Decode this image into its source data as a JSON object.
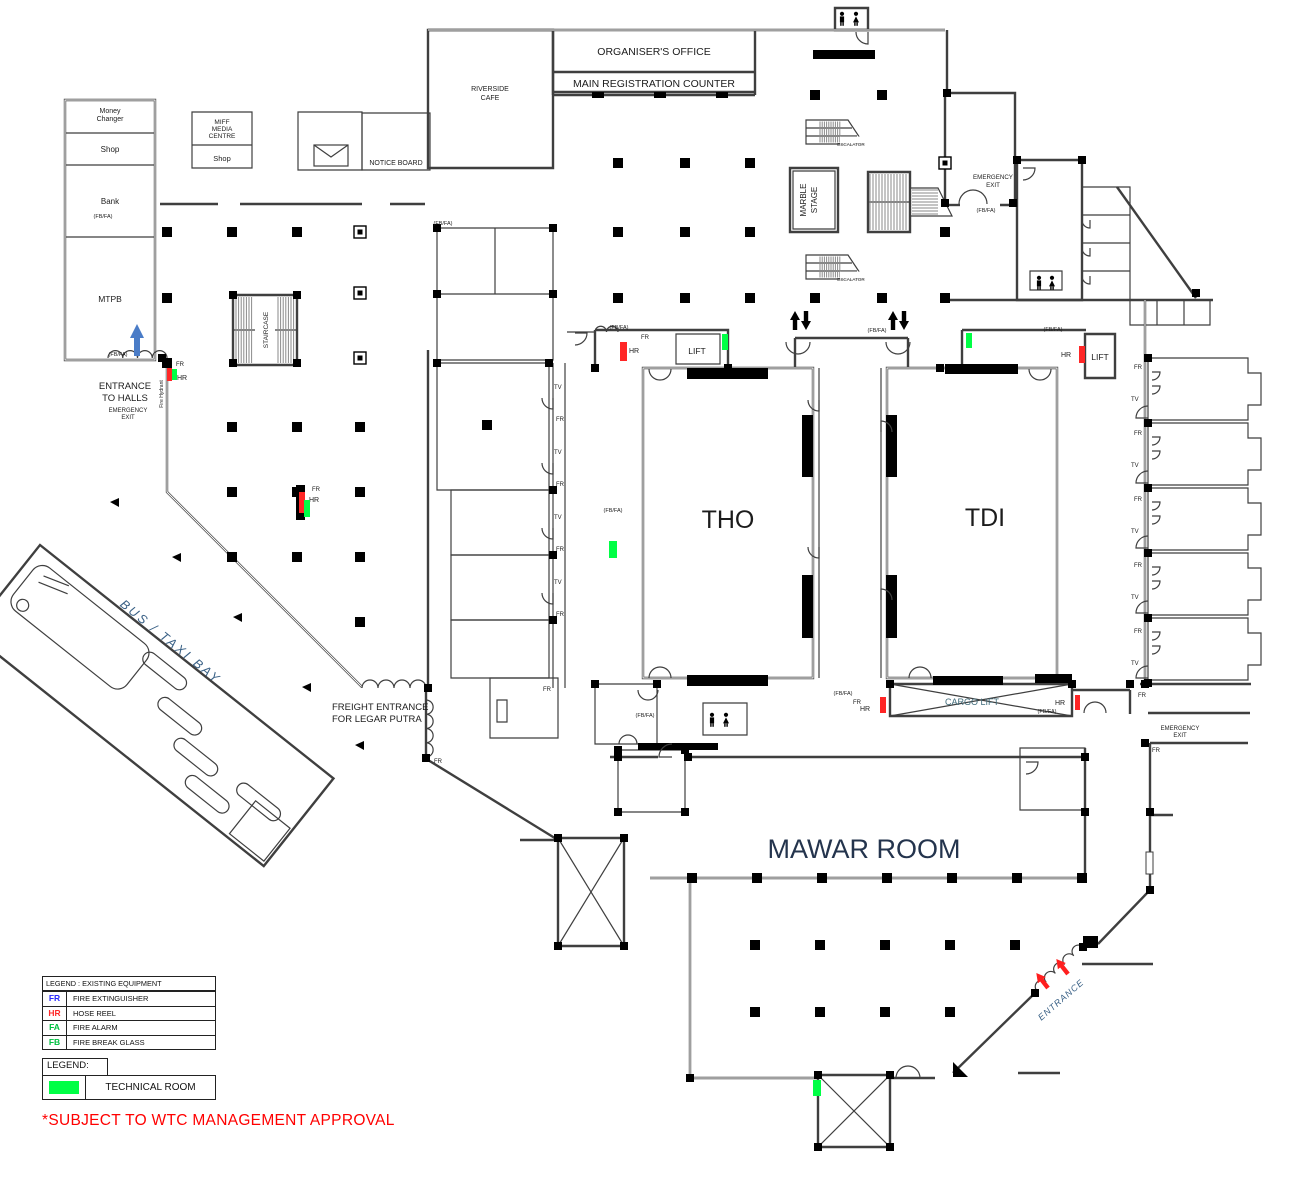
{
  "labels": {
    "shops": {
      "money_changer_l1": "Money",
      "money_changer_l2": "Changer",
      "shop_top": "Shop",
      "bank": "Bank",
      "mtpb": "MTPB",
      "miff_l1": "MIFF",
      "miff_l2": "MEDIA",
      "miff_l3": "CENTRE",
      "shop_mid": "Shop"
    },
    "top": {
      "notice_board": "NOTICE BOARD",
      "riverside_l1": "RIVERSIDE",
      "riverside_l2": "CAFE",
      "organisers_office": "ORGANISER'S OFFICE",
      "main_registration": "MAIN REGISTRATION COUNTER"
    },
    "halls": {
      "tho": "THO",
      "tdi": "TDI",
      "mawar": "MAWAR ROOM",
      "marble_l1": "MARBLE",
      "marble_l2": "STAGE",
      "staircase": "STAIRCASE",
      "escalator": "ESCALATOR",
      "lift": "LIFT",
      "cargo_lift": "CARGO LIFT"
    },
    "circulation": {
      "entrance_to_halls_l1": "ENTRANCE",
      "entrance_to_halls_l2": "TO HALLS",
      "emergency_l1": "EMERGENCY",
      "emergency_l2": "EXIT",
      "entrance": "ENTRANCE",
      "bus_taxi_bay": "BUS / TAXI BAY",
      "freight_l1": "FREIGHT ENTRANCE",
      "freight_l2": "FOR LEGAR PUTRA",
      "fire_hydrant": "Fire Hydrant"
    }
  },
  "legend_equipment": {
    "title": "LEGEND : EXISTING EQUIPMENT",
    "items": [
      {
        "code": "FR",
        "label": "FIRE EXTINGUISHER",
        "color": "#2929ff"
      },
      {
        "code": "HR",
        "label": "HOSE REEL",
        "color": "#ff2a2a"
      },
      {
        "code": "FA",
        "label": "FIRE ALARM",
        "color": "#00c040"
      },
      {
        "code": "FB",
        "label": "FIRE BREAK GLASS",
        "color": "#00c040"
      }
    ]
  },
  "legend_technical": {
    "title": "LEGEND:",
    "label": "TECHNICAL ROOM",
    "swatch": "#00ff45"
  },
  "note": {
    "text": "*SUBJECT TO WTC MANAGEMENT APPROVAL",
    "color": "#ff0000"
  },
  "markers": {
    "fr": {
      "label": "FR",
      "color": "#3a3aff",
      "pos": [
        [
          176,
          366
        ],
        [
          312,
          491
        ],
        [
          641,
          339
        ],
        [
          543,
          691
        ],
        [
          853,
          704
        ],
        [
          1138,
          697
        ],
        [
          1152,
          752
        ],
        [
          434,
          763
        ],
        [
          556,
          421
        ],
        [
          556,
          486
        ],
        [
          556,
          551
        ],
        [
          556,
          616
        ],
        [
          1134,
          369
        ],
        [
          1134,
          435
        ],
        [
          1134,
          501
        ],
        [
          1134,
          567
        ],
        [
          1134,
          633
        ]
      ]
    },
    "tv": {
      "label": "TV",
      "color": "#e08a2e",
      "pos": [
        [
          554,
          389
        ],
        [
          554,
          454
        ],
        [
          554,
          519
        ],
        [
          554,
          584
        ],
        [
          1131,
          401
        ],
        [
          1131,
          467
        ],
        [
          1131,
          533
        ],
        [
          1131,
          599
        ],
        [
          1131,
          665
        ]
      ]
    },
    "hr": {
      "label": "HR",
      "color": "#ff2626",
      "items": [
        {
          "box": [
            167,
            368,
            5,
            13
          ],
          "t": [
            177,
            380
          ]
        },
        {
          "box": [
            299,
            492,
            6,
            21
          ],
          "t": [
            309,
            502
          ]
        },
        {
          "box": [
            620,
            342,
            7,
            19
          ],
          "t": [
            629,
            353
          ]
        },
        {
          "box": [
            1079,
            346,
            6,
            17
          ],
          "t": [
            1061,
            357
          ]
        },
        {
          "box": [
            880,
            697,
            6,
            16
          ],
          "t": [
            860,
            711
          ]
        },
        {
          "box": [
            1075,
            695,
            5,
            15
          ],
          "t": [
            1055,
            705
          ]
        }
      ]
    },
    "fbfa": {
      "label": "(FB/FA)",
      "color": "#2fbf5f",
      "pos": [
        [
          103,
          218
        ],
        [
          118,
          356
        ],
        [
          443,
          225
        ],
        [
          619,
          329
        ],
        [
          877,
          332
        ],
        [
          1053,
          331
        ],
        [
          986,
          212
        ],
        [
          613,
          512
        ],
        [
          645,
          717
        ],
        [
          843,
          695
        ],
        [
          1047,
          713
        ]
      ]
    },
    "tech": {
      "color": "#00ff45",
      "rects": [
        [
          722,
          334,
          6,
          16
        ],
        [
          966,
          333,
          6,
          15
        ],
        [
          609,
          541,
          8,
          17
        ],
        [
          304,
          500,
          6,
          17
        ],
        [
          813,
          1080,
          8,
          16
        ],
        [
          172,
          369,
          5,
          11
        ]
      ]
    }
  }
}
